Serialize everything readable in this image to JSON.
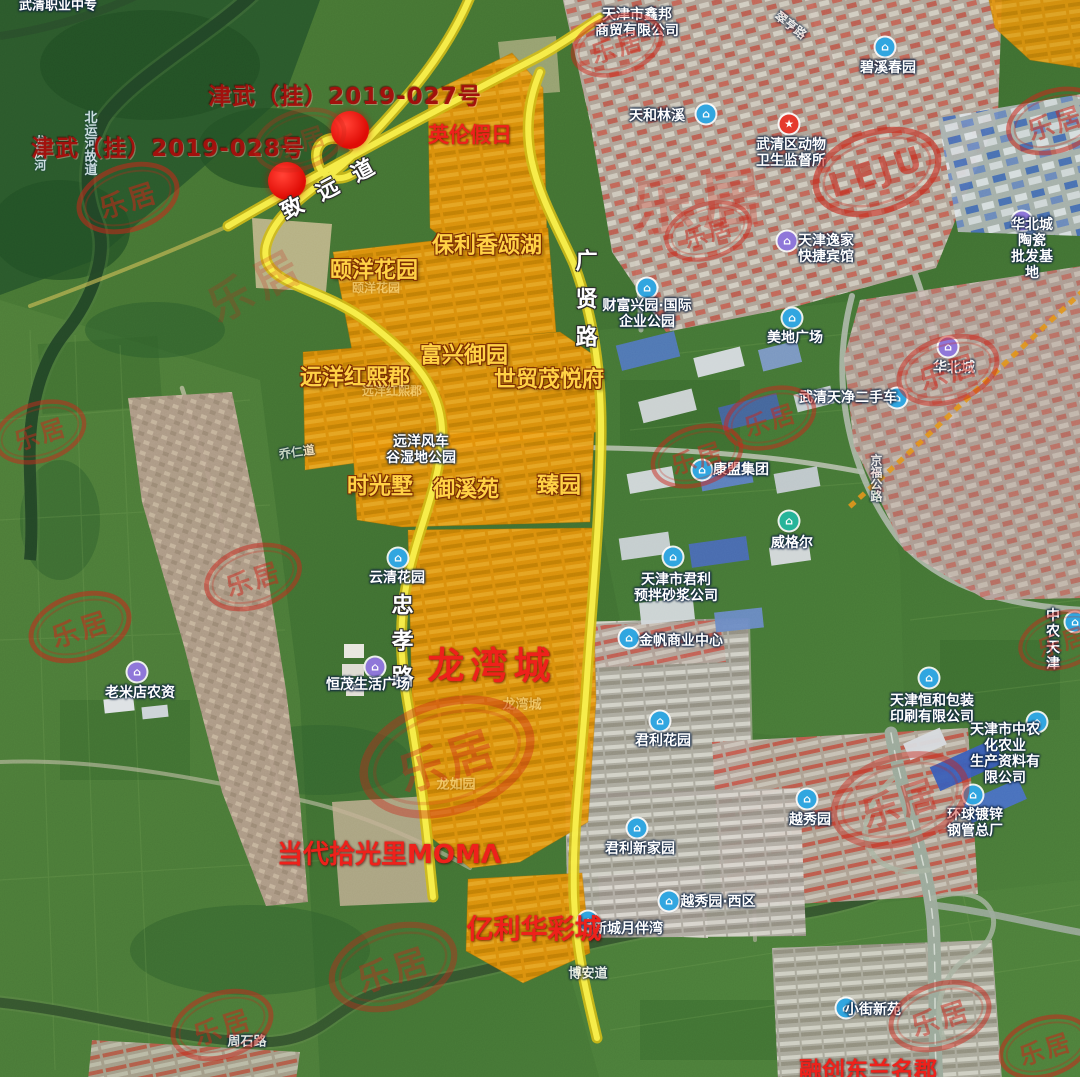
{
  "colors": {
    "road_yellow": "#f8ef4f",
    "parcel_orange": "#e09110",
    "dot_red": "#d90f08",
    "stamp_red": "#c5281c",
    "label_gold": "#ffd24a",
    "label_red": "#e8231d",
    "parcel_label_red": "#9e120e",
    "poi_blue": "#35a5dd",
    "poi_purple": "#8f77d6",
    "poi_green": "#2bb39a"
  },
  "watermark": {
    "brand": "乐居",
    "brand_latin": "LEJU"
  },
  "icon_glyphs": {
    "blue": "⌂",
    "purple": "⌂",
    "green": "⌂",
    "redstar": "★"
  },
  "map": {
    "land_parcels": [
      {
        "label": "津武（挂）2019-027号",
        "x": 345,
        "y": 97,
        "dot": {
          "x": 350,
          "y": 130,
          "r": 19
        }
      },
      {
        "label": "津武（挂）2019-028号",
        "x": 168,
        "y": 149,
        "dot": {
          "x": 287,
          "y": 181,
          "r": 19
        }
      }
    ],
    "labels": [
      {
        "t": "redlbl",
        "text": "英伦假日",
        "x": 470,
        "y": 135,
        "s": 21,
        "n": "community-yinglunjiari"
      },
      {
        "t": "gold",
        "text": "保利香颂湖",
        "x": 487,
        "y": 246,
        "s": 22,
        "n": "community-baoli-xiangsonghu"
      },
      {
        "t": "gold",
        "text": "颐洋花园",
        "x": 374,
        "y": 271,
        "s": 22,
        "n": "community-yiyang-huayuan"
      },
      {
        "t": "ghost",
        "text": "颐洋花园",
        "x": 376,
        "y": 289,
        "s": 12
      },
      {
        "t": "roadlbl",
        "text": "致远道",
        "x": 336,
        "y": 186,
        "s": 22,
        "r": -28,
        "sp": 18,
        "n": "road-zhiyuandao"
      },
      {
        "t": "roadlbl",
        "text": "广贤路",
        "x": 584,
        "y": 306,
        "s": 22,
        "v": 1,
        "sp": 16,
        "n": "road-guangxianlu"
      },
      {
        "t": "poi",
        "text": "财富兴园·国际\n企业公园",
        "x": 647,
        "y": 314
      },
      {
        "t": "gold",
        "text": "富兴御园",
        "x": 464,
        "y": 356,
        "s": 22,
        "n": "community-fuxing-yuyuan"
      },
      {
        "t": "gold",
        "text": "远洋红熙郡",
        "x": 355,
        "y": 378,
        "s": 22,
        "n": "community-yuanyang-hongxijun"
      },
      {
        "t": "ghost",
        "text": "远洋红熙郡",
        "x": 392,
        "y": 392,
        "s": 12
      },
      {
        "t": "gold",
        "text": "世贸茂悦府",
        "x": 549,
        "y": 380,
        "s": 22,
        "n": "community-shimao-maoyuefu"
      },
      {
        "t": "poi",
        "text": "远洋风车\n谷湿地公园",
        "x": 421,
        "y": 450
      },
      {
        "t": "gold",
        "text": "时光墅",
        "x": 380,
        "y": 487,
        "s": 22,
        "n": "community-shiguangshu"
      },
      {
        "t": "gold",
        "text": "御溪苑",
        "x": 466,
        "y": 490,
        "s": 22,
        "n": "community-yuxiyuan"
      },
      {
        "t": "gold",
        "text": "臻园",
        "x": 559,
        "y": 486,
        "s": 22,
        "n": "community-zhenyuan"
      },
      {
        "t": "poi",
        "text": "康盟集团",
        "x": 741,
        "y": 470
      },
      {
        "t": "poi",
        "text": "威格尔",
        "x": 792,
        "y": 543
      },
      {
        "t": "poi",
        "text": "美地广场",
        "x": 795,
        "y": 338
      },
      {
        "t": "poi",
        "text": "武清天净二手车",
        "x": 848,
        "y": 398
      },
      {
        "t": "poi",
        "text": "天津市君利\n预拌砂浆公司",
        "x": 676,
        "y": 588
      },
      {
        "t": "poi",
        "text": "金帆商业中心",
        "x": 681,
        "y": 641
      },
      {
        "t": "poi",
        "text": "云清花园",
        "x": 397,
        "y": 578
      },
      {
        "t": "roadlbl",
        "text": "忠孝路",
        "x": 400,
        "y": 647,
        "s": 22,
        "v": 1,
        "sp": 14,
        "n": "road-zhongxiaolu"
      },
      {
        "t": "redlbl",
        "text": "龙湾城",
        "x": 492,
        "y": 667,
        "s": 37,
        "sp": 6,
        "n": "community-longwancheng"
      },
      {
        "t": "ghost",
        "text": "龙湾城",
        "x": 522,
        "y": 706,
        "s": 13
      },
      {
        "t": "ghost",
        "text": "龙如园",
        "x": 456,
        "y": 786,
        "s": 13
      },
      {
        "t": "poi",
        "text": "恒茂生活广场",
        "x": 368,
        "y": 685
      },
      {
        "t": "poi",
        "text": "老米店农资",
        "x": 140,
        "y": 693
      },
      {
        "t": "poi",
        "text": "君利花园",
        "x": 663,
        "y": 741
      },
      {
        "t": "poi",
        "text": "君利新家园",
        "x": 640,
        "y": 849
      },
      {
        "t": "poi",
        "text": "越秀园",
        "x": 810,
        "y": 820
      },
      {
        "t": "poi",
        "text": "越秀园·西区",
        "x": 718,
        "y": 902
      },
      {
        "t": "redlbl",
        "text": "当代拾光里MOMΛ",
        "x": 389,
        "y": 856,
        "s": 26,
        "n": "community-moma"
      },
      {
        "t": "poi",
        "text": "新城月伴湾",
        "x": 628,
        "y": 929,
        "z": 48
      },
      {
        "t": "redlbl",
        "text": "亿利华彩城",
        "x": 534,
        "y": 930,
        "s": 27,
        "z": 52,
        "n": "community-yili-huacaicheng"
      },
      {
        "t": "poi",
        "text": "环球镀锌\n钢管总厂",
        "x": 975,
        "y": 823
      },
      {
        "t": "poi",
        "text": "天津恒和包装\n印刷有限公司",
        "x": 932,
        "y": 709
      },
      {
        "t": "poi",
        "text": "天津市中农化农业\n生产资料有限公司",
        "x": 1005,
        "y": 754
      },
      {
        "t": "poi",
        "text": "中农天津",
        "x": 1053,
        "y": 640
      },
      {
        "t": "poi",
        "text": "碧溪春园",
        "x": 888,
        "y": 68
      },
      {
        "t": "poi",
        "text": "天和林溪",
        "x": 657,
        "y": 116
      },
      {
        "t": "poi",
        "text": "武清区动物\n卫生监督所",
        "x": 791,
        "y": 153
      },
      {
        "t": "poi",
        "text": "天津市鑫邦\n商贸有限公司",
        "x": 637,
        "y": 23
      },
      {
        "t": "poi",
        "text": "天津逸家\n快捷宾馆",
        "x": 826,
        "y": 249
      },
      {
        "t": "poi",
        "text": "华北城陶瓷\n批发基地",
        "x": 1032,
        "y": 249
      },
      {
        "t": "poi",
        "text": "华北城",
        "x": 954,
        "y": 368,
        "o": 0.85
      },
      {
        "t": "poi",
        "text": "小街新苑",
        "x": 873,
        "y": 1010
      },
      {
        "t": "redlbl",
        "text": "融创东兰名郡",
        "x": 868,
        "y": 1071,
        "s": 23,
        "n": "community-rongchuang"
      },
      {
        "t": "poi",
        "text": "武清职业中专",
        "x": 58,
        "y": 7,
        "s": 13
      },
      {
        "t": "water",
        "text": "北运河故道",
        "x": 88,
        "y": 143,
        "v": 1,
        "s": 13
      },
      {
        "t": "water",
        "text": "龙凤河",
        "x": 39,
        "y": 153,
        "v": 1,
        "s": 12
      },
      {
        "t": "poi",
        "text": "周石路",
        "x": 247,
        "y": 1043,
        "s": 13,
        "o": 0.85
      },
      {
        "t": "poi",
        "text": "博安道",
        "x": 588,
        "y": 975,
        "s": 13,
        "o": 0.85
      },
      {
        "t": "poi",
        "text": "京福公路",
        "x": 875,
        "y": 478,
        "v": 1,
        "s": 12,
        "o": 0.75
      },
      {
        "t": "poi",
        "text": "乔仁道",
        "x": 297,
        "y": 453,
        "s": 12,
        "o": 0.7,
        "r": -8
      },
      {
        "t": "poi",
        "text": "翠亨路",
        "x": 790,
        "y": 26,
        "s": 12,
        "o": 0.75,
        "r": 38
      }
    ],
    "poi_icons": [
      {
        "c": "blue",
        "x": 647,
        "y": 288
      },
      {
        "c": "blue",
        "x": 702,
        "y": 470
      },
      {
        "c": "green",
        "x": 789,
        "y": 521
      },
      {
        "c": "blue",
        "x": 792,
        "y": 318
      },
      {
        "c": "blue",
        "x": 897,
        "y": 398
      },
      {
        "c": "blue",
        "x": 673,
        "y": 557
      },
      {
        "c": "blue",
        "x": 629,
        "y": 638
      },
      {
        "c": "blue",
        "x": 398,
        "y": 558
      },
      {
        "c": "purple",
        "x": 375,
        "y": 667
      },
      {
        "c": "purple",
        "x": 137,
        "y": 672
      },
      {
        "c": "blue",
        "x": 660,
        "y": 721
      },
      {
        "c": "blue",
        "x": 637,
        "y": 828
      },
      {
        "c": "blue",
        "x": 807,
        "y": 799
      },
      {
        "c": "blue",
        "x": 669,
        "y": 901
      },
      {
        "c": "blue",
        "x": 588,
        "y": 921
      },
      {
        "c": "blue",
        "x": 973,
        "y": 795
      },
      {
        "c": "blue",
        "x": 929,
        "y": 678
      },
      {
        "c": "blue",
        "x": 1037,
        "y": 722
      },
      {
        "c": "blue",
        "x": 1075,
        "y": 622
      },
      {
        "c": "blue",
        "x": 885,
        "y": 47
      },
      {
        "c": "blue",
        "x": 706,
        "y": 114
      },
      {
        "c": "redstar",
        "x": 789,
        "y": 124
      },
      {
        "c": "purple",
        "x": 787,
        "y": 241
      },
      {
        "c": "purple",
        "x": 1022,
        "y": 221
      },
      {
        "c": "blue",
        "x": 846,
        "y": 1008
      },
      {
        "c": "purple",
        "x": 948,
        "y": 347
      }
    ],
    "stamps": [
      {
        "x": 128,
        "y": 198,
        "sc": 1.0,
        "o": 0.55
      },
      {
        "x": 617,
        "y": 45,
        "sc": 0.9,
        "o": 0.5
      },
      {
        "x": 708,
        "y": 231,
        "sc": 0.85,
        "o": 0.5
      },
      {
        "x": 1055,
        "y": 121,
        "sc": 0.95,
        "o": 0.55
      },
      {
        "x": 877,
        "y": 172,
        "sc": 1.25,
        "o": 0.6,
        "tx": "LEJU"
      },
      {
        "x": 697,
        "y": 456,
        "sc": 0.9,
        "o": 0.5
      },
      {
        "x": 770,
        "y": 418,
        "sc": 0.9,
        "o": 0.5
      },
      {
        "x": 948,
        "y": 370,
        "sc": 1.0,
        "o": 0.5
      },
      {
        "x": 40,
        "y": 432,
        "sc": 0.9,
        "o": 0.5
      },
      {
        "x": 80,
        "y": 627,
        "sc": 1.0,
        "o": 0.55
      },
      {
        "x": 253,
        "y": 577,
        "sc": 0.95,
        "o": 0.5
      },
      {
        "x": 447,
        "y": 757,
        "sc": 1.7,
        "o": 0.4
      },
      {
        "x": 900,
        "y": 800,
        "sc": 1.35,
        "o": 0.45
      },
      {
        "x": 940,
        "y": 1016,
        "sc": 1.0,
        "o": 0.5
      },
      {
        "x": 393,
        "y": 967,
        "sc": 1.25,
        "o": 0.4
      },
      {
        "x": 222,
        "y": 1025,
        "sc": 1.0,
        "o": 0.5
      },
      {
        "x": 1045,
        "y": 1047,
        "sc": 0.9,
        "o": 0.55
      },
      {
        "x": 1062,
        "y": 640,
        "sc": 0.85,
        "o": 0.45
      },
      {
        "x": 300,
        "y": 140,
        "sc": 0.9,
        "o": 0.3
      }
    ],
    "watermark_texts": [
      {
        "x": 700,
        "y": 197,
        "s": 62,
        "r": -6,
        "o": 0.3
      },
      {
        "x": 255,
        "y": 282,
        "s": 44,
        "r": -28,
        "o": 0.22
      }
    ]
  }
}
